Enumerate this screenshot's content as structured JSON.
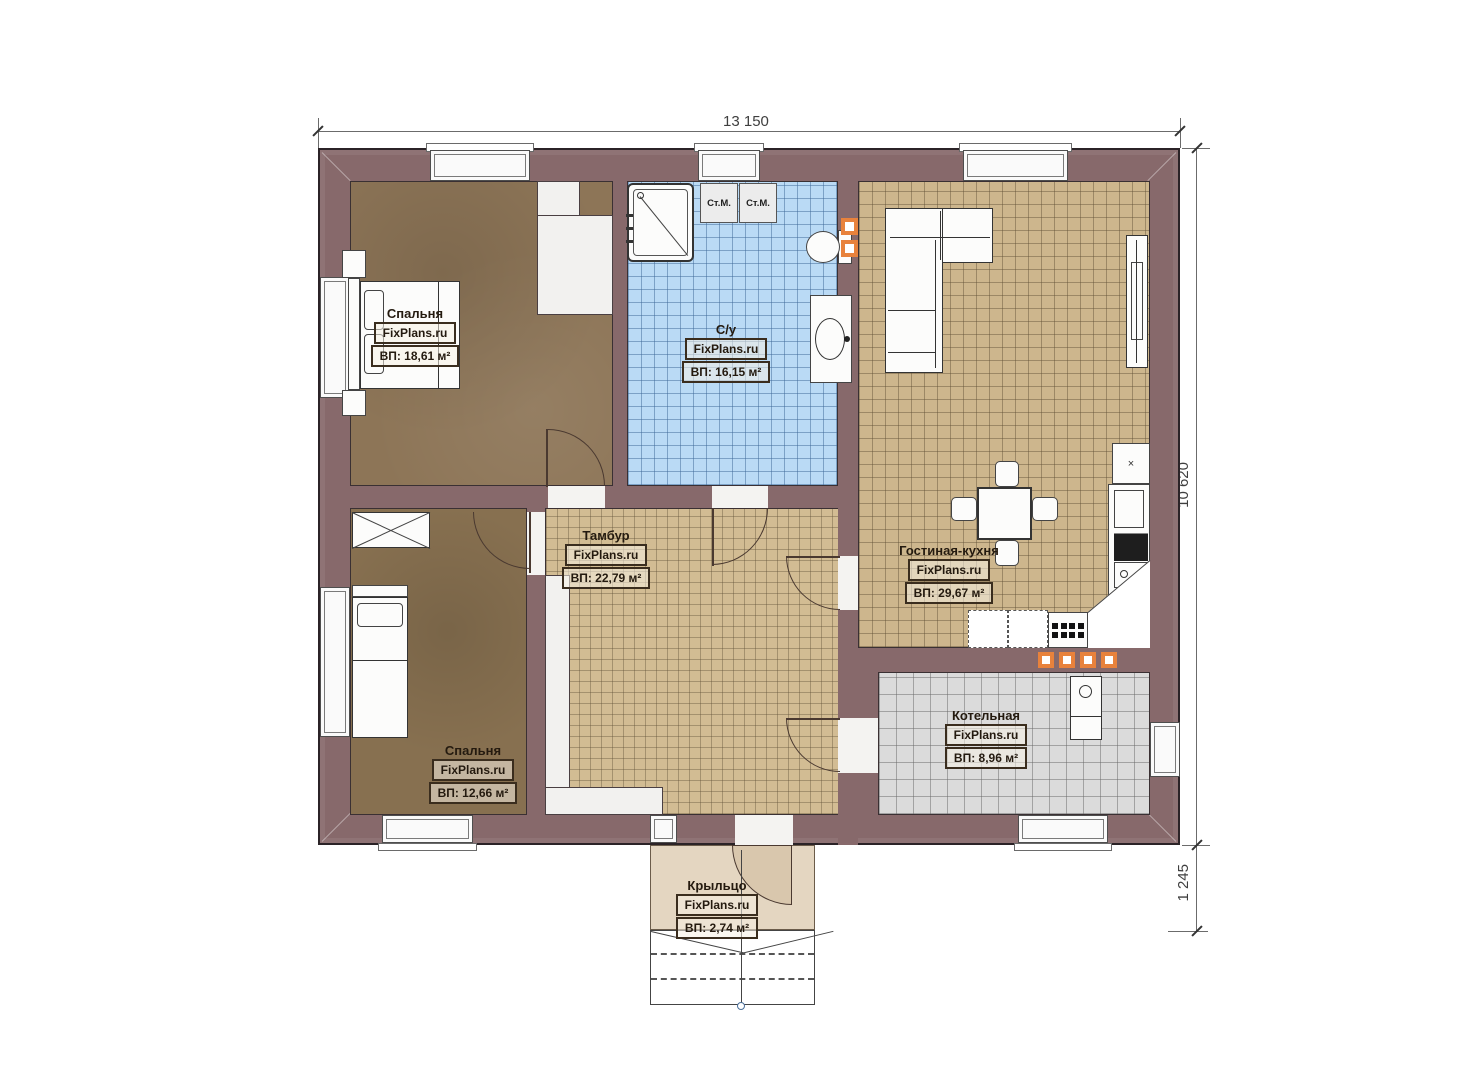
{
  "plan": {
    "brand": "FixPlans.ru",
    "dimensions": {
      "top": "13 150",
      "right": "10 620",
      "porch": "1 245"
    },
    "rooms": {
      "bedroom1": {
        "name": "Спальня",
        "brand": "FixPlans.ru",
        "area": "ВП: 18,61 м²"
      },
      "bathroom": {
        "name": "С/у",
        "brand": "FixPlans.ru",
        "area": "ВП: 16,15 м²"
      },
      "living_kitchen": {
        "name": "Гостиная-кухня",
        "brand": "FixPlans.ru",
        "area": "ВП: 29,67 м²"
      },
      "hall": {
        "name": "Тамбур",
        "brand": "FixPlans.ru",
        "area": "ВП: 22,79 м²"
      },
      "bedroom2": {
        "name": "Спальня",
        "brand": "FixPlans.ru",
        "area": "ВП: 12,66 м²"
      },
      "boiler": {
        "name": "Котельная",
        "brand": "FixPlans.ru",
        "area": "ВП: 8,96 м²"
      },
      "porch": {
        "name": "Крыльцо",
        "brand": "FixPlans.ru",
        "area": "ВП: 2,74 м²"
      }
    },
    "appliances": {
      "washing_machine": "Ст.М.",
      "fridge_mark": "×"
    },
    "colors": {
      "wall": "#87696b",
      "wood_floor": "#8d7557",
      "tan_tile": "#cdb68d",
      "blue_tile": "#badaf5",
      "gray_tile": "#dbdbdb",
      "porch_floor": "#e4d6c1",
      "accent_orange": "#e8823c"
    }
  }
}
